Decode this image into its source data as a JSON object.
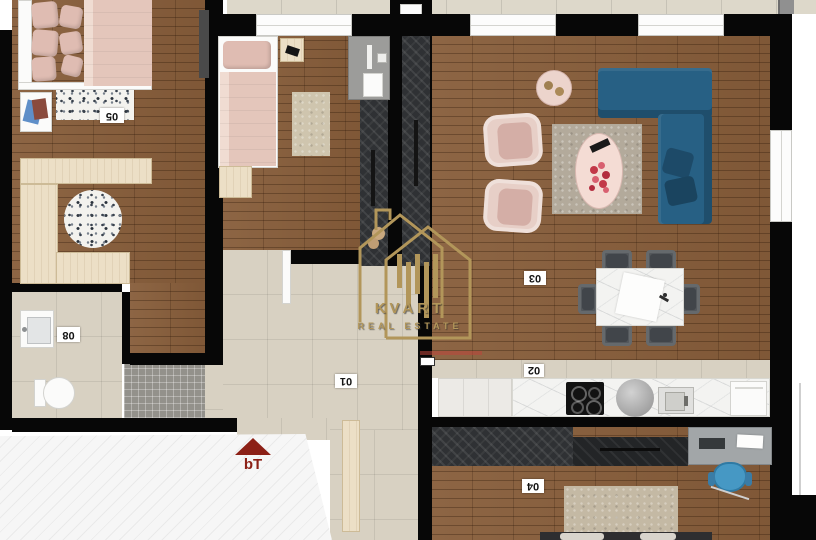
{
  "watermark": {
    "brand": "KVART",
    "tagline": "REAL ESTATE"
  },
  "entrance": {
    "marker": "bT"
  },
  "rooms": {
    "bedroom_main": {
      "label": "05"
    },
    "bathroom": {
      "label": "08"
    },
    "hallway": {
      "label": "01"
    },
    "kitchen": {
      "label": "02"
    },
    "living_dining": {
      "label": "03"
    },
    "bottom_room": {
      "label": "04"
    }
  },
  "colors": {
    "wall": "#070707",
    "wood_floor": "#875d3a",
    "tile_floor": "#d8d1c2",
    "sofa_blue": "#276084",
    "accent_gold": "#b2965a",
    "entrance_red": "#8c2016",
    "armchair_pink": "#e7cfc7",
    "office_chair_blue": "#4698c4"
  }
}
